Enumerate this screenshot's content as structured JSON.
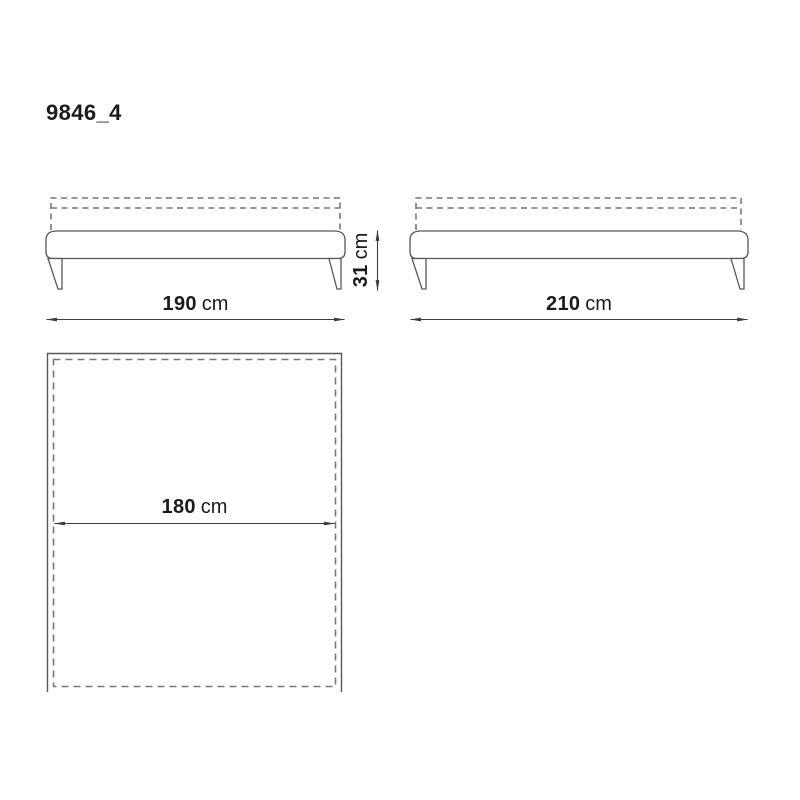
{
  "page": {
    "background": "#ffffff",
    "line_color": "#58585a",
    "dash_color": "#77777a",
    "text_color": "#1b1b1b"
  },
  "title": "9846_4",
  "dimensions": {
    "front_width": {
      "value": "190",
      "unit": "cm"
    },
    "front_height": {
      "value": "31",
      "unit": "cm"
    },
    "side_width": {
      "value": "210",
      "unit": "cm"
    },
    "top_width": {
      "value": "180",
      "unit": "cm"
    }
  }
}
